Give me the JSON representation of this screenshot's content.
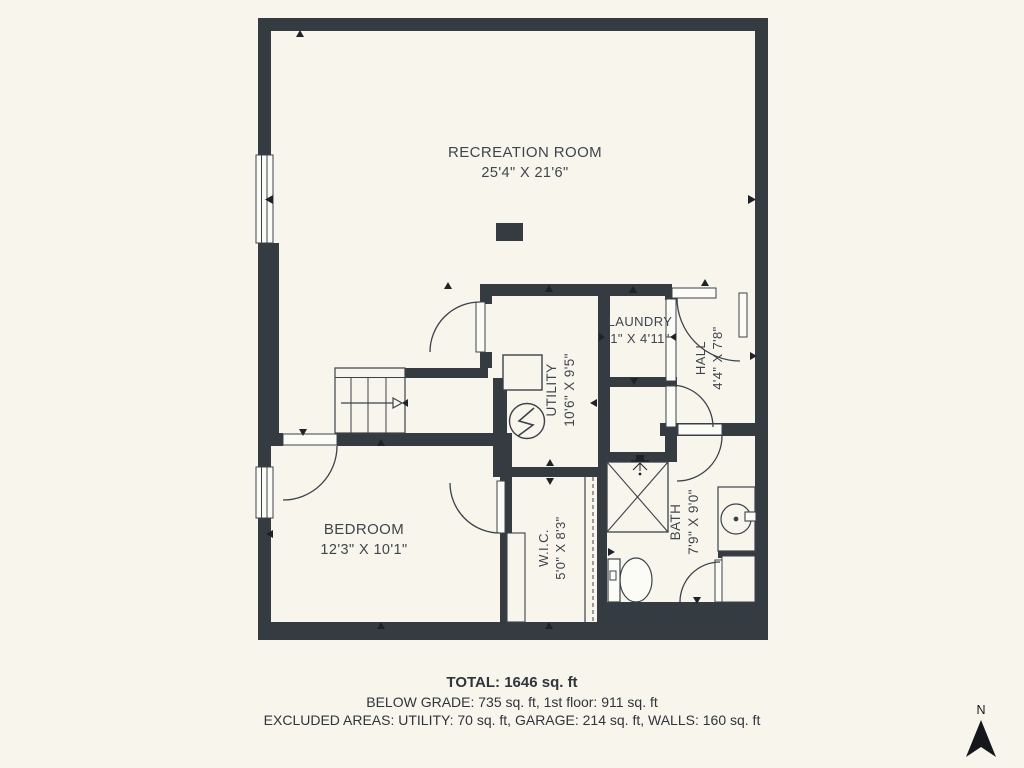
{
  "colors": {
    "background": "#f7f5ec",
    "wall": "#343b41",
    "line": "#3b434a",
    "text": "#3e464d",
    "marker": "#1d2327"
  },
  "rooms": {
    "recreation": {
      "name": "RECREATION ROOM",
      "dims": "25'4\" X 21'6\""
    },
    "utility": {
      "name": "UTILITY",
      "dims": "10'6\" X 9'5\""
    },
    "laundry": {
      "name": "LAUNDRY",
      "dims": "1\" X 4'11\""
    },
    "hall": {
      "name": "HALL",
      "dims": "4'4\" X 7'8\""
    },
    "bedroom": {
      "name": "BEDROOM",
      "dims": "12'3\" X 10'1\""
    },
    "wic": {
      "name": "W.I.C.",
      "dims": "5'0\" X 8'3\""
    },
    "bath": {
      "name": "BATH",
      "dims": "7'9\" X 9'0\""
    }
  },
  "footer": {
    "total": "TOTAL: 1646 sq. ft",
    "grade": "BELOW GRADE: 735 sq. ft, 1st floor: 911 sq. ft",
    "excluded": "EXCLUDED AREAS: UTILITY: 70 sq. ft, GARAGE: 214 sq. ft, WALLS: 160 sq. ft"
  },
  "compass": {
    "label": "N"
  }
}
